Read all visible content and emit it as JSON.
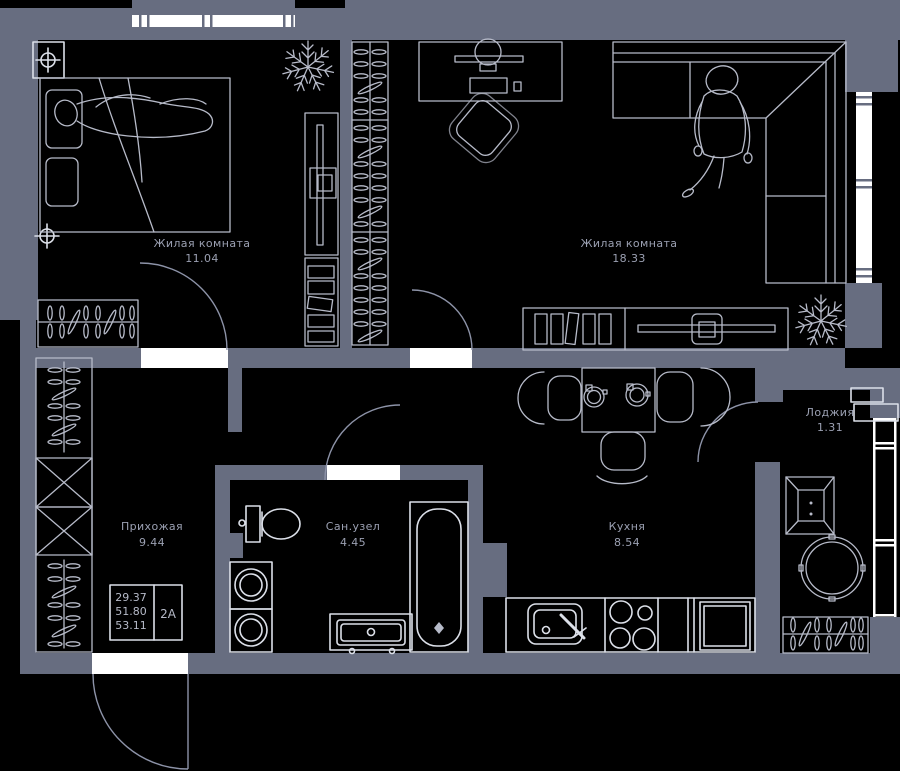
{
  "plan": {
    "rooms": [
      {
        "key": "bedroom",
        "name": "Жилая комната",
        "area": "11.04"
      },
      {
        "key": "living_room",
        "name": "Жилая комната",
        "area": "18.33"
      },
      {
        "key": "hallway",
        "name": "Прихожая",
        "area": "9.44"
      },
      {
        "key": "bathroom",
        "name": "Сан.узел",
        "area": "4.45"
      },
      {
        "key": "kitchen",
        "name": "Кухня",
        "area": "8.54"
      },
      {
        "key": "loggia",
        "name": "Лоджия",
        "area": "1.31"
      }
    ],
    "info_box": {
      "values": [
        "29.37",
        "51.80",
        "53.11"
      ],
      "unit": "2А"
    },
    "colors": {
      "background": "#000000",
      "wall": "#676d80",
      "line": "#b7bbc9",
      "bright_line": "#dce0e9",
      "opening": "#ffffff",
      "label_text": "#9ba0b2"
    }
  }
}
